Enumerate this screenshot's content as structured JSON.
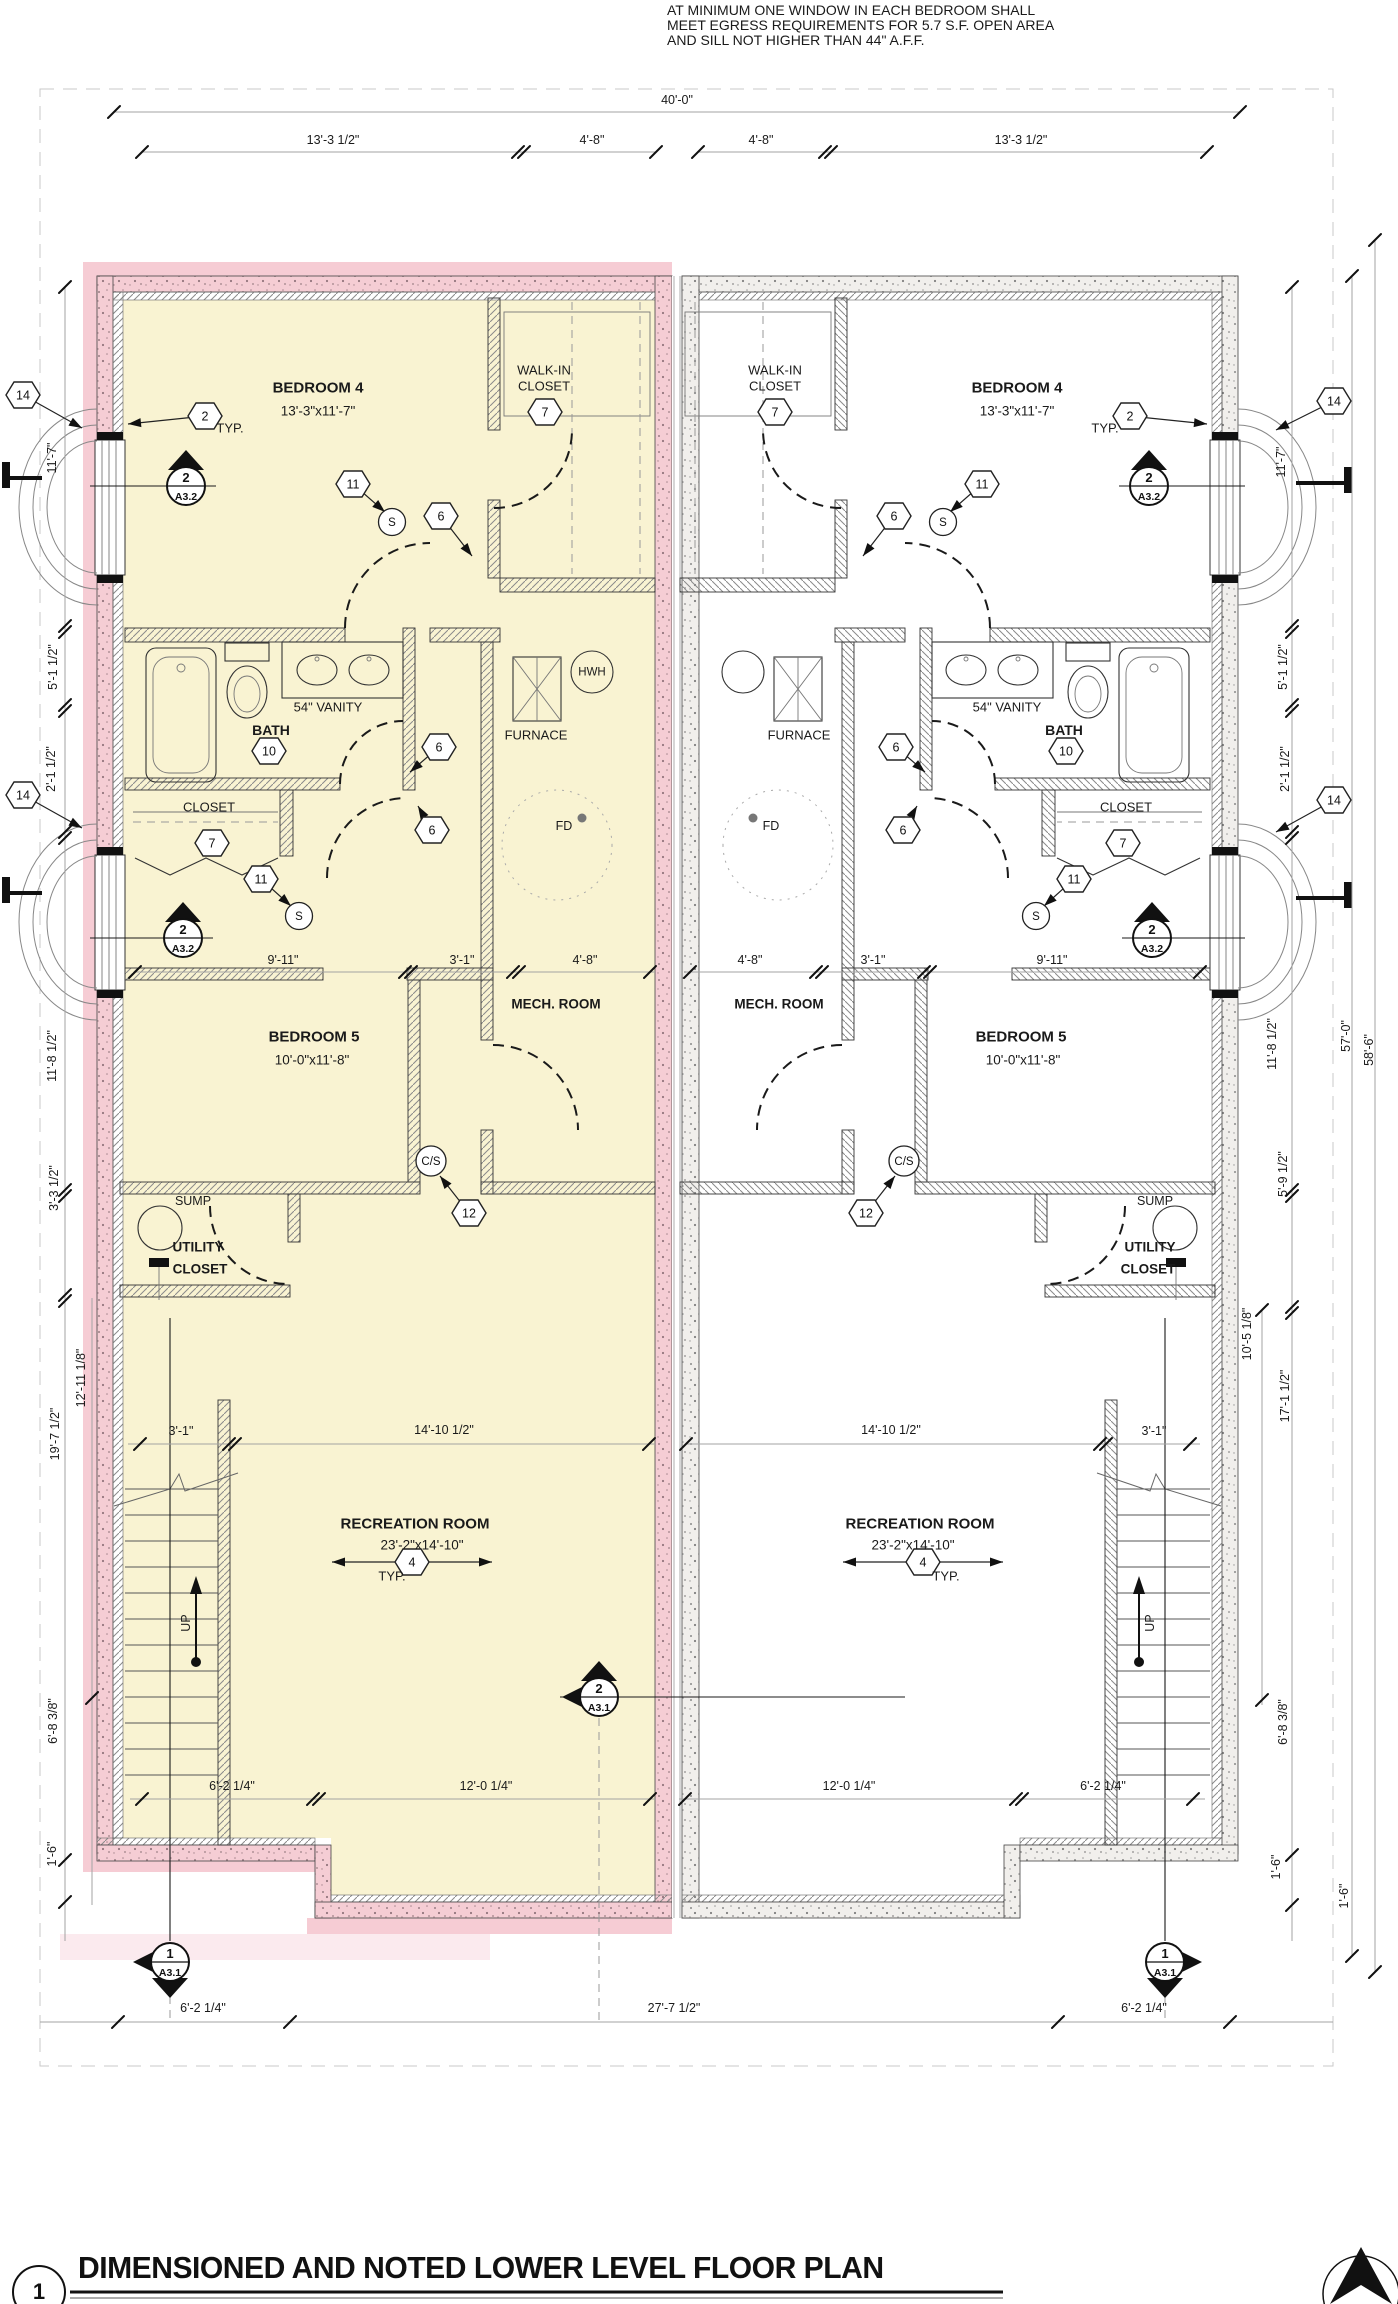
{
  "colors": {
    "unit_highlight_fill": "#f9f3d2",
    "wall_highlight": "#f5cdd4",
    "wall_concrete": "#f1efec",
    "accent_pink_halo": "#f6ccd4",
    "line": "#1a1a1a"
  },
  "note": {
    "line1": "AT MINIMUM ONE WINDOW IN EACH BEDROOM SHALL",
    "line2": "MEET EGRESS REQUIREMENTS FOR 5.7 S.F. OPEN AREA",
    "line3": "AND SILL NOT HIGHER THAN 44\" A.F.F."
  },
  "title_block": {
    "detail_number": "1",
    "title": "DIMENSIONED AND NOTED LOWER LEVEL FLOOR PLAN"
  },
  "labels": [
    {
      "name": "note-line-1",
      "text": "AT MINIMUM ONE WINDOW IN EACH BEDROOM SHALL",
      "x": 667,
      "y": 10,
      "s": 14,
      "a": "l"
    },
    {
      "name": "note-line-2",
      "text": "MEET EGRESS REQUIREMENTS FOR 5.7 S.F. OPEN AREA",
      "x": 667,
      "y": 25,
      "s": 14,
      "a": "l"
    },
    {
      "name": "note-line-3",
      "text": "AND SILL NOT HIGHER THAN 44\" A.F.F.",
      "x": 667,
      "y": 40,
      "s": 14,
      "a": "l"
    },
    {
      "name": "dim-overall-width",
      "text": "40'-0\"",
      "x": 677,
      "y": 100,
      "s": 12.5
    },
    {
      "name": "dim-top",
      "text": "13'-3 1/2\"",
      "x": 333,
      "y": 140,
      "s": 12.5
    },
    {
      "name": "dim-top",
      "text": "4'-8\"",
      "x": 592,
      "y": 140,
      "s": 12.5
    },
    {
      "name": "dim-top",
      "text": "4'-8\"",
      "x": 761,
      "y": 140,
      "s": 12.5
    },
    {
      "name": "dim-top",
      "text": "13'-3 1/2\"",
      "x": 1021,
      "y": 140,
      "s": 12.5
    },
    {
      "name": "room-bedroom4-left",
      "text": "BEDROOM 4",
      "x": 318,
      "y": 388,
      "s": 15,
      "b": 1
    },
    {
      "name": "size-bedroom4-left",
      "text": "13'-3\"x11'-7\"",
      "x": 318,
      "y": 411,
      "s": 13.5
    },
    {
      "name": "room-bedroom4-right",
      "text": "BEDROOM 4",
      "x": 1017,
      "y": 388,
      "s": 15,
      "b": 1
    },
    {
      "name": "size-bedroom4-right",
      "text": "13'-3\"x11'-7\"",
      "x": 1017,
      "y": 411,
      "s": 13.5
    },
    {
      "name": "room-walkin-left",
      "text": "WALK-IN",
      "x": 544,
      "y": 370,
      "s": 13
    },
    {
      "name": "room-walkin-left",
      "text": "CLOSET",
      "x": 544,
      "y": 386,
      "s": 13
    },
    {
      "name": "room-walkin-right",
      "text": "WALK-IN",
      "x": 775,
      "y": 370,
      "s": 13
    },
    {
      "name": "room-walkin-right",
      "text": "CLOSET",
      "x": 775,
      "y": 386,
      "s": 13
    },
    {
      "name": "typ-note-left",
      "text": "TYP.",
      "x": 230,
      "y": 428,
      "s": 13
    },
    {
      "name": "typ-note-right",
      "text": "TYP.",
      "x": 1105,
      "y": 428,
      "s": 13
    },
    {
      "name": "label-vanity-left",
      "text": "54\" VANITY",
      "x": 328,
      "y": 707,
      "s": 13
    },
    {
      "name": "label-vanity-right",
      "text": "54\" VANITY",
      "x": 1007,
      "y": 707,
      "s": 13
    },
    {
      "name": "room-bath-left",
      "text": "BATH",
      "x": 271,
      "y": 730,
      "s": 14,
      "b": 1
    },
    {
      "name": "room-bath-right",
      "text": "BATH",
      "x": 1064,
      "y": 730,
      "s": 14,
      "b": 1
    },
    {
      "name": "label-furnace-left",
      "text": "FURNACE",
      "x": 536,
      "y": 735,
      "s": 13
    },
    {
      "name": "label-furnace-right",
      "text": "FURNACE",
      "x": 799,
      "y": 735,
      "s": 13
    },
    {
      "name": "label-hwh",
      "text": "HWH",
      "x": 592,
      "y": 673,
      "s": 11.5
    },
    {
      "name": "room-closet-left",
      "text": "CLOSET",
      "x": 209,
      "y": 807,
      "s": 13
    },
    {
      "name": "room-closet-right",
      "text": "CLOSET",
      "x": 1126,
      "y": 807,
      "s": 13
    },
    {
      "name": "label-floor-drain-left",
      "text": "FD",
      "x": 564,
      "y": 826,
      "s": 12.5
    },
    {
      "name": "label-floor-drain-right",
      "text": "FD",
      "x": 771,
      "y": 826,
      "s": 12.5
    },
    {
      "name": "room-mech-left",
      "text": "MECH. ROOM",
      "x": 556,
      "y": 1004,
      "s": 13.5,
      "b": 1
    },
    {
      "name": "room-mech-right",
      "text": "MECH. ROOM",
      "x": 779,
      "y": 1004,
      "s": 13.5,
      "b": 1
    },
    {
      "name": "dim-mid-left",
      "text": "9'-11\"",
      "x": 283,
      "y": 960,
      "s": 12.5
    },
    {
      "name": "dim-mid-left",
      "text": "3'-1\"",
      "x": 462,
      "y": 960,
      "s": 12.5
    },
    {
      "name": "dim-mid-left",
      "text": "4'-8\"",
      "x": 585,
      "y": 960,
      "s": 12.5
    },
    {
      "name": "dim-mid-right",
      "text": "4'-8\"",
      "x": 750,
      "y": 960,
      "s": 12.5
    },
    {
      "name": "dim-mid-right",
      "text": "3'-1\"",
      "x": 873,
      "y": 960,
      "s": 12.5
    },
    {
      "name": "dim-mid-right",
      "text": "9'-11\"",
      "x": 1052,
      "y": 960,
      "s": 12.5
    },
    {
      "name": "room-bedroom5-left",
      "text": "BEDROOM 5",
      "x": 314,
      "y": 1037,
      "s": 15,
      "b": 1
    },
    {
      "name": "size-bedroom5-left",
      "text": "10'-0\"x11'-8\"",
      "x": 312,
      "y": 1060,
      "s": 13.5
    },
    {
      "name": "room-bedroom5-right",
      "text": "BEDROOM 5",
      "x": 1021,
      "y": 1037,
      "s": 15,
      "b": 1
    },
    {
      "name": "size-bedroom5-right",
      "text": "10'-0\"x11'-8\"",
      "x": 1023,
      "y": 1060,
      "s": 13.5
    },
    {
      "name": "label-sump-left",
      "text": "SUMP",
      "x": 193,
      "y": 1201,
      "s": 12.5
    },
    {
      "name": "label-sump-right",
      "text": "SUMP",
      "x": 1155,
      "y": 1201,
      "s": 12.5
    },
    {
      "name": "room-utility-left",
      "text": "UTILITY",
      "x": 198,
      "y": 1247,
      "s": 13.5,
      "b": 1
    },
    {
      "name": "room-utility-left",
      "text": "CLOSET",
      "x": 200,
      "y": 1269,
      "s": 13.5,
      "b": 1
    },
    {
      "name": "room-utility-right",
      "text": "UTILITY",
      "x": 1150,
      "y": 1247,
      "s": 13.5,
      "b": 1
    },
    {
      "name": "room-utility-right",
      "text": "CLOSET",
      "x": 1148,
      "y": 1269,
      "s": 13.5,
      "b": 1
    },
    {
      "name": "dim-stair-left",
      "text": "3'-1\"",
      "x": 181,
      "y": 1431,
      "s": 12.5
    },
    {
      "name": "dim-rec-left",
      "text": "14'-10 1/2\"",
      "x": 444,
      "y": 1430,
      "s": 12.5
    },
    {
      "name": "dim-rec-right",
      "text": "14'-10 1/2\"",
      "x": 891,
      "y": 1430,
      "s": 12.5
    },
    {
      "name": "dim-stair-right",
      "text": "3'-1\"",
      "x": 1154,
      "y": 1431,
      "s": 12.5
    },
    {
      "name": "room-rec-left",
      "text": "RECREATION ROOM",
      "x": 415,
      "y": 1524,
      "s": 15,
      "b": 1
    },
    {
      "name": "size-rec-left",
      "text": "23'-2\"x14'-10\"",
      "x": 422,
      "y": 1545,
      "s": 13.5
    },
    {
      "name": "typ-note-rec-left",
      "text": "TYP.",
      "x": 392,
      "y": 1576,
      "s": 13
    },
    {
      "name": "room-rec-right",
      "text": "RECREATION ROOM",
      "x": 920,
      "y": 1524,
      "s": 15,
      "b": 1
    },
    {
      "name": "size-rec-right",
      "text": "23'-2\"x14'-10\"",
      "x": 913,
      "y": 1545,
      "s": 13.5
    },
    {
      "name": "typ-note-rec-right",
      "text": "TYP.",
      "x": 946,
      "y": 1576,
      "s": 13
    },
    {
      "name": "label-up-left",
      "text": "UP",
      "x": 186,
      "y": 1623,
      "s": 12.5,
      "r": 1
    },
    {
      "name": "label-up-right",
      "text": "UP",
      "x": 1150,
      "y": 1623,
      "s": 12.5,
      "r": 1
    },
    {
      "name": "dim-bottom-int-left",
      "text": "6'-2 1/4\"",
      "x": 232,
      "y": 1786,
      "s": 12.5
    },
    {
      "name": "dim-bottom-int-left",
      "text": "12'-0 1/4\"",
      "x": 486,
      "y": 1786,
      "s": 12.5
    },
    {
      "name": "dim-bottom-int-right",
      "text": "12'-0 1/4\"",
      "x": 849,
      "y": 1786,
      "s": 12.5
    },
    {
      "name": "dim-bottom-int-right",
      "text": "6'-2 1/4\"",
      "x": 1103,
      "y": 1786,
      "s": 12.5
    },
    {
      "name": "dim-bottom-row",
      "text": "6'-2 1/4\"",
      "x": 203,
      "y": 2008,
      "s": 12.5
    },
    {
      "name": "dim-bottom-row",
      "text": "27'-7 1/2\"",
      "x": 674,
      "y": 2008,
      "s": 12.5
    },
    {
      "name": "dim-bottom-row",
      "text": "6'-2 1/4\"",
      "x": 1144,
      "y": 2008,
      "s": 12.5
    },
    {
      "name": "dim-left-col",
      "text": "11'-7\"",
      "x": 52,
      "y": 458,
      "s": 12.5,
      "r": 1
    },
    {
      "name": "dim-left-col",
      "text": "5'-1 1/2\"",
      "x": 53,
      "y": 667,
      "s": 12.5,
      "r": 1
    },
    {
      "name": "dim-left-col",
      "text": "2'-1 1/2\"",
      "x": 51,
      "y": 769,
      "s": 12.5,
      "r": 1
    },
    {
      "name": "dim-left-col",
      "text": "11'-8 1/2\"",
      "x": 52,
      "y": 1056,
      "s": 12.5,
      "r": 1
    },
    {
      "name": "dim-left-col",
      "text": "3'-3 1/2\"",
      "x": 54,
      "y": 1188,
      "s": 12.5,
      "r": 1
    },
    {
      "name": "dim-left-col",
      "text": "12'-11 1/8\"",
      "x": 81,
      "y": 1378,
      "s": 12.5,
      "r": 1
    },
    {
      "name": "dim-left-col",
      "text": "19'-7 1/2\"",
      "x": 55,
      "y": 1434,
      "s": 12.5,
      "r": 1
    },
    {
      "name": "dim-left-col",
      "text": "6'-8 3/8\"",
      "x": 53,
      "y": 1721,
      "s": 12.5,
      "r": 1
    },
    {
      "name": "dim-left-col",
      "text": "1'-6\"",
      "x": 52,
      "y": 1854,
      "s": 12.5,
      "r": 1
    },
    {
      "name": "dim-right-col",
      "text": "11'-7\"",
      "x": 1281,
      "y": 462,
      "s": 12.5,
      "r": 1
    },
    {
      "name": "dim-right-col",
      "text": "5'-1 1/2\"",
      "x": 1283,
      "y": 667,
      "s": 12.5,
      "r": 1
    },
    {
      "name": "dim-right-col",
      "text": "2'-1 1/2\"",
      "x": 1285,
      "y": 769,
      "s": 12.5,
      "r": 1
    },
    {
      "name": "dim-right-col",
      "text": "11'-8 1/2\"",
      "x": 1272,
      "y": 1044,
      "s": 12.5,
      "r": 1
    },
    {
      "name": "dim-right-col",
      "text": "5'-9 1/2\"",
      "x": 1283,
      "y": 1174,
      "s": 12.5,
      "r": 1
    },
    {
      "name": "dim-right-col",
      "text": "10'-5 1/8\"",
      "x": 1247,
      "y": 1334,
      "s": 12.5,
      "r": 1
    },
    {
      "name": "dim-right-col",
      "text": "17'-1 1/2\"",
      "x": 1285,
      "y": 1396,
      "s": 12.5,
      "r": 1
    },
    {
      "name": "dim-right-col",
      "text": "6'-8 3/8\"",
      "x": 1283,
      "y": 1722,
      "s": 12.5,
      "r": 1
    },
    {
      "name": "dim-right-col",
      "text": "1'-6\"",
      "x": 1276,
      "y": 1867,
      "s": 12.5,
      "r": 1
    },
    {
      "name": "dim-right-col",
      "text": "1'-6\"",
      "x": 1344,
      "y": 1896,
      "s": 12.5,
      "r": 1
    },
    {
      "name": "dim-overall-height",
      "text": "57'-0\"",
      "x": 1346,
      "y": 1036,
      "s": 12.5,
      "r": 1
    },
    {
      "name": "dim-overall-height",
      "text": "58'-6\"",
      "x": 1369,
      "y": 1050,
      "s": 12.5,
      "r": 1
    }
  ],
  "hex_markers": [
    {
      "n": "2",
      "x": 205,
      "y": 416,
      "ax": 128,
      "ay": 424
    },
    {
      "n": "2",
      "x": 1130,
      "y": 416,
      "ax": 1207,
      "ay": 424
    },
    {
      "n": "7",
      "x": 545,
      "y": 412
    },
    {
      "n": "7",
      "x": 775,
      "y": 412
    },
    {
      "n": "11",
      "x": 353,
      "y": 484,
      "ax": 385,
      "ay": 512
    },
    {
      "n": "11",
      "x": 982,
      "y": 484,
      "ax": 950,
      "ay": 512
    },
    {
      "n": "6",
      "x": 441,
      "y": 516,
      "ax": 472,
      "ay": 556
    },
    {
      "n": "6",
      "x": 894,
      "y": 516,
      "ax": 863,
      "ay": 556
    },
    {
      "n": "10",
      "x": 269,
      "y": 751
    },
    {
      "n": "10",
      "x": 1066,
      "y": 751
    },
    {
      "n": "6",
      "x": 439,
      "y": 747,
      "ax": 410,
      "ay": 772
    },
    {
      "n": "6",
      "x": 896,
      "y": 747,
      "ax": 925,
      "ay": 772
    },
    {
      "n": "6",
      "x": 432,
      "y": 830,
      "ax": 418,
      "ay": 806
    },
    {
      "n": "6",
      "x": 903,
      "y": 830,
      "ax": 917,
      "ay": 806
    },
    {
      "n": "7",
      "x": 212,
      "y": 843
    },
    {
      "n": "7",
      "x": 1123,
      "y": 843
    },
    {
      "n": "11",
      "x": 261,
      "y": 879,
      "ax": 291,
      "ay": 906
    },
    {
      "n": "11",
      "x": 1074,
      "y": 879,
      "ax": 1044,
      "ay": 906
    },
    {
      "n": "12",
      "x": 469,
      "y": 1213,
      "ax": 440,
      "ay": 1176
    },
    {
      "n": "12",
      "x": 866,
      "y": 1213,
      "ax": 895,
      "ay": 1176
    },
    {
      "n": "4",
      "x": 412,
      "y": 1562,
      "dbl": 1
    },
    {
      "n": "4",
      "x": 923,
      "y": 1562,
      "dbl": 1
    },
    {
      "n": "14",
      "x": 23,
      "y": 395,
      "ax": 82,
      "ay": 428
    },
    {
      "n": "14",
      "x": 1334,
      "y": 401,
      "ax": 1276,
      "ay": 430
    },
    {
      "n": "14",
      "x": 23,
      "y": 795,
      "ax": 82,
      "ay": 828
    },
    {
      "n": "14",
      "x": 1334,
      "y": 800,
      "ax": 1276,
      "ay": 832
    }
  ],
  "circle_markers": [
    {
      "t": "S",
      "x": 392,
      "y": 522,
      "r": 13.5
    },
    {
      "t": "S",
      "x": 943,
      "y": 522,
      "r": 13.5
    },
    {
      "t": "S",
      "x": 299,
      "y": 916,
      "r": 13.5
    },
    {
      "t": "S",
      "x": 1036,
      "y": 916,
      "r": 13.5
    },
    {
      "t": "C/S",
      "x": 431,
      "y": 1161,
      "r": 15
    },
    {
      "t": "C/S",
      "x": 904,
      "y": 1161,
      "r": 15
    }
  ],
  "section_markers": [
    {
      "num": "2",
      "sheet": "A3.2",
      "x": 186,
      "y": 486,
      "tris": [
        "up"
      ],
      "line": [
        90,
        216
      ]
    },
    {
      "num": "2",
      "sheet": "A3.2",
      "x": 1149,
      "y": 486,
      "tris": [
        "up"
      ],
      "line": [
        1119,
        1245
      ]
    },
    {
      "num": "2",
      "sheet": "A3.2",
      "x": 183,
      "y": 938,
      "tris": [
        "up"
      ],
      "line": [
        90,
        213
      ]
    },
    {
      "num": "2",
      "sheet": "A3.2",
      "x": 1152,
      "y": 938,
      "tris": [
        "up"
      ],
      "line": [
        1122,
        1245
      ]
    },
    {
      "num": "2",
      "sheet": "A3.1",
      "x": 599,
      "y": 1697,
      "tris": [
        "up",
        "left"
      ],
      "line": [
        560,
        905
      ]
    },
    {
      "num": "1",
      "sheet": "A3.1",
      "x": 170,
      "y": 1962,
      "tris": [
        "left",
        "down"
      ]
    },
    {
      "num": "1",
      "sheet": "A3.1",
      "x": 1165,
      "y": 1962,
      "tris": [
        "right",
        "down"
      ]
    }
  ]
}
